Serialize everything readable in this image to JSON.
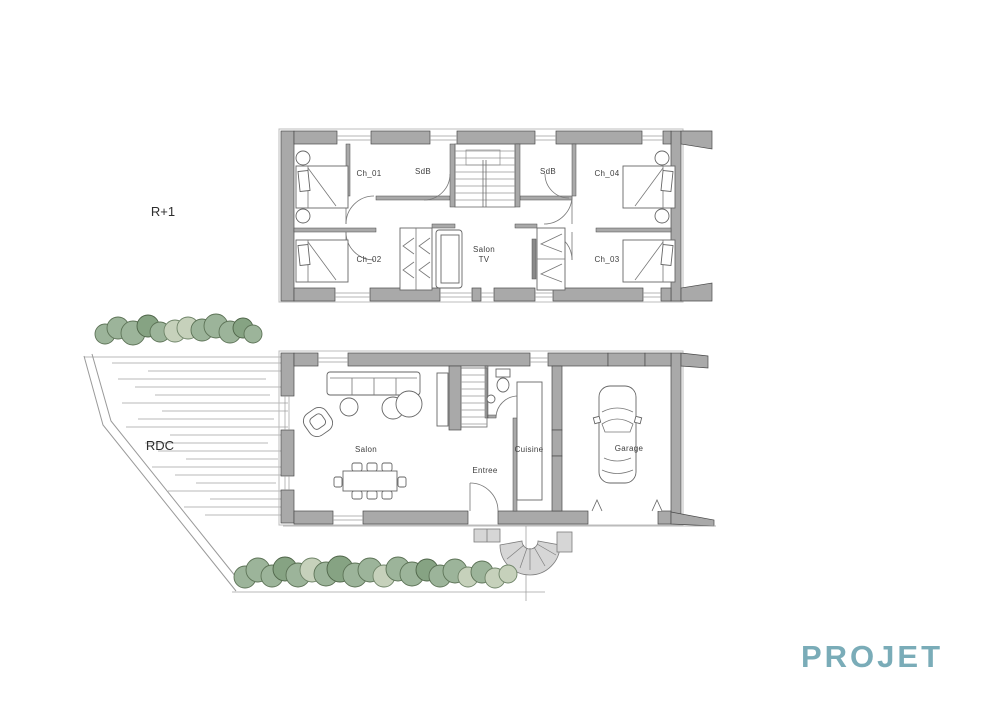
{
  "document": {
    "type_label": "architectural floor plan drawing",
    "background": "#ffffff"
  },
  "watermark": {
    "text": "PROJET",
    "color": "#6fa6b2"
  },
  "floors": {
    "upper": {
      "label": "R+1",
      "rooms": {
        "ch01": "Ch_01",
        "ch02": "Ch_02",
        "ch03": "Ch_03",
        "ch04": "Ch_04",
        "sdb_left": "SdB",
        "sdb_right": "SdB",
        "salon_tv_line1": "Salon",
        "salon_tv_line2": "TV"
      }
    },
    "ground": {
      "label": "RDC",
      "rooms": {
        "salon": "Salon",
        "entree": "Entree",
        "cuisine": "Cuisine",
        "garage": "Garage"
      }
    }
  },
  "colors": {
    "wall": "#a9a9a9",
    "vegetation_medium": "#9cb49a",
    "vegetation_light": "#c6d1bb",
    "vegetation_dark": "#86a383",
    "watermark": "#6fa6b2"
  }
}
